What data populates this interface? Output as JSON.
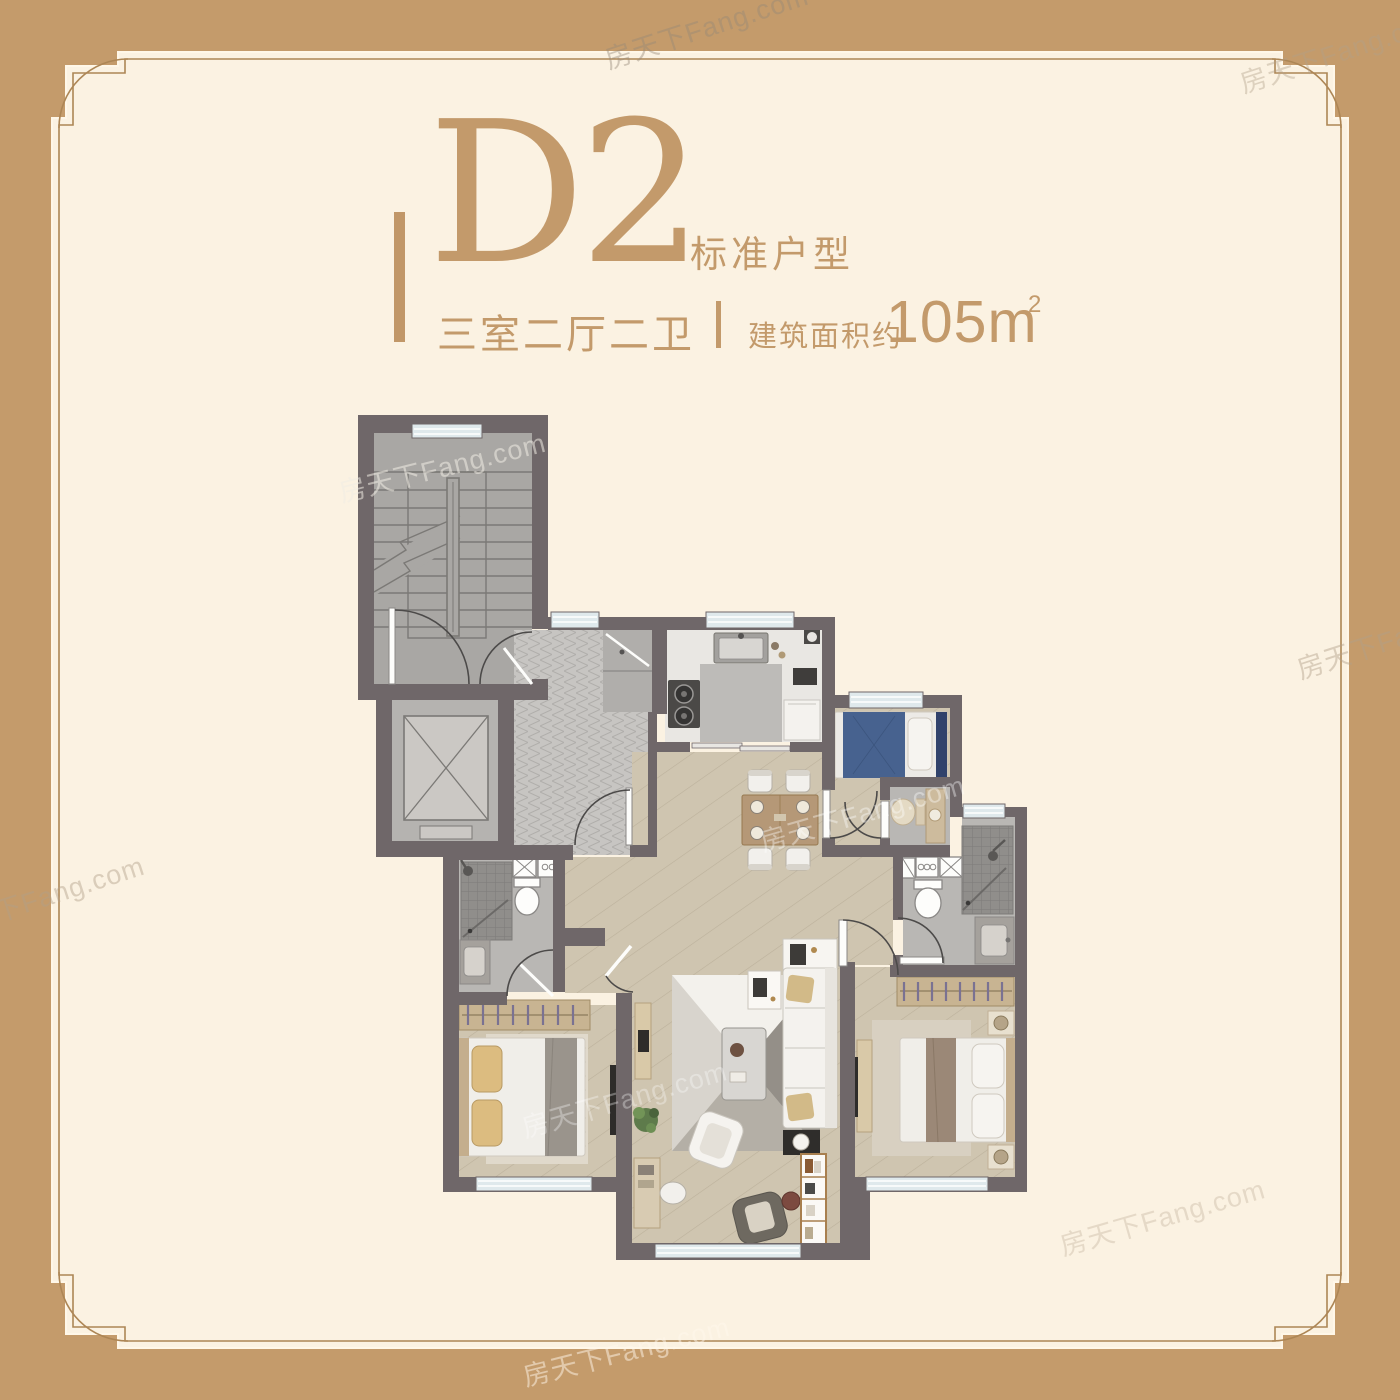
{
  "title": {
    "code": "D2",
    "type_label": "标准户型",
    "layout_label": "三室二厅二卫",
    "area_label": "建筑面积约",
    "area_value": "105m",
    "area_exponent": "2"
  },
  "watermark": {
    "text": "房天下Fang.com"
  },
  "colors": {
    "outer_background": "#c49b6b",
    "panel_cream": "#fbf2e2",
    "frame_line": "#ad8655",
    "accent_text": "#c39a6b",
    "wall": "#6f6769",
    "wood_floor": "#cfc5b0",
    "tile_floor": "#b9b7b4",
    "stair_floor": "#a9a7a4",
    "herringbone_floor": "#c7c5c2",
    "window": "#dfe9ec",
    "bed_blue": "#47628f",
    "pillow_tan": "#dcbc80",
    "throw_brown": "#9b8877",
    "wardrobe_wood": "#c8b492",
    "dining_table": "#b59877"
  }
}
